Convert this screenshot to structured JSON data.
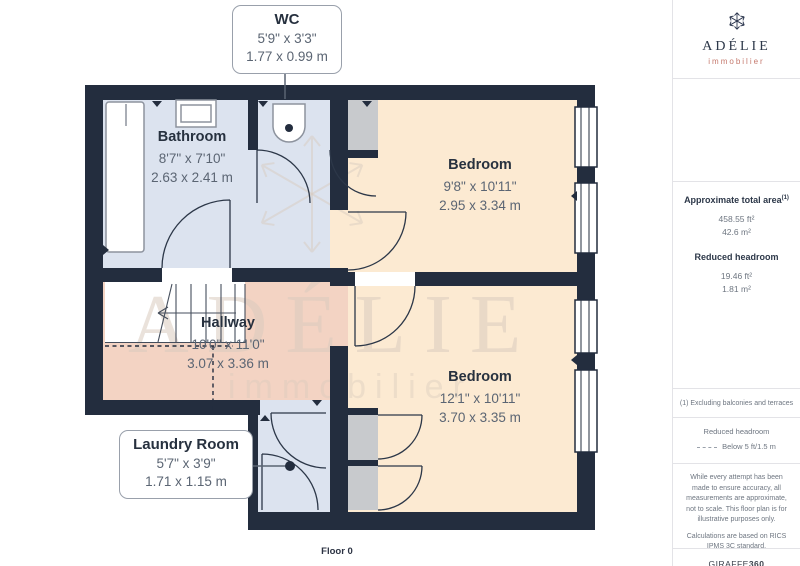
{
  "page": {
    "floor_label": "Floor 0"
  },
  "plan": {
    "watermark": {
      "title": "ADÉLIE",
      "subtitle": "immobilier"
    },
    "rooms": {
      "wc": {
        "name": "WC",
        "imperial": "5'9\" x 3'3\"",
        "metric": "1.77 x 0.99 m"
      },
      "bathroom": {
        "name": "Bathroom",
        "imperial": "8'7\" x 7'10\"",
        "metric": "2.63 x 2.41 m"
      },
      "bedroom_top": {
        "name": "Bedroom",
        "imperial": "9'8\" x 10'11\"",
        "metric": "2.95 x 3.34 m"
      },
      "hallway": {
        "name": "Hallway",
        "imperial": "10'0\" x 11'0\"",
        "metric": "3.07 x 3.36 m"
      },
      "bedroom_bottom": {
        "name": "Bedroom",
        "imperial": "12'1\" x 10'11\"",
        "metric": "3.70 x 3.35 m"
      },
      "laundry": {
        "name": "Laundry Room",
        "imperial": "5'7\" x 3'9\"",
        "metric": "1.71 x 1.15 m"
      }
    }
  },
  "sidebar": {
    "brand": {
      "name": "ADÉLIE",
      "tagline": "immobilier"
    },
    "total_area": {
      "title": "Approximate total area",
      "footnote_marker": "(1)",
      "imperial": "458.55 ft²",
      "metric": "42.6 m²"
    },
    "reduced_headroom": {
      "title": "Reduced headroom",
      "imperial": "19.46 ft²",
      "metric": "1.81 m²"
    },
    "footnote": "(1) Excluding balconies and terraces",
    "legend": {
      "title": "Reduced headroom",
      "item": "Below 5 ft/1.5 m"
    },
    "disclaimer": "While every attempt has been made to ensure accuracy, all measurements are approximate, not to scale. This floor plan is for illustrative purposes only.",
    "standard_note": "Calculations are based on RICS IPMS 3C standard.",
    "credit": {
      "name": "GIRAFFE",
      "suffix": "360"
    }
  },
  "colors": {
    "wall": "#232d3e",
    "floor_wet": "#dce3ef",
    "floor_bedroom": "#fcead2",
    "floor_hallway": "#f3d3c3",
    "floor_closet": "#c8cacd",
    "accent_coral": "#c5796d",
    "navy": "#2d3849",
    "text_dim": "#5b6573"
  }
}
